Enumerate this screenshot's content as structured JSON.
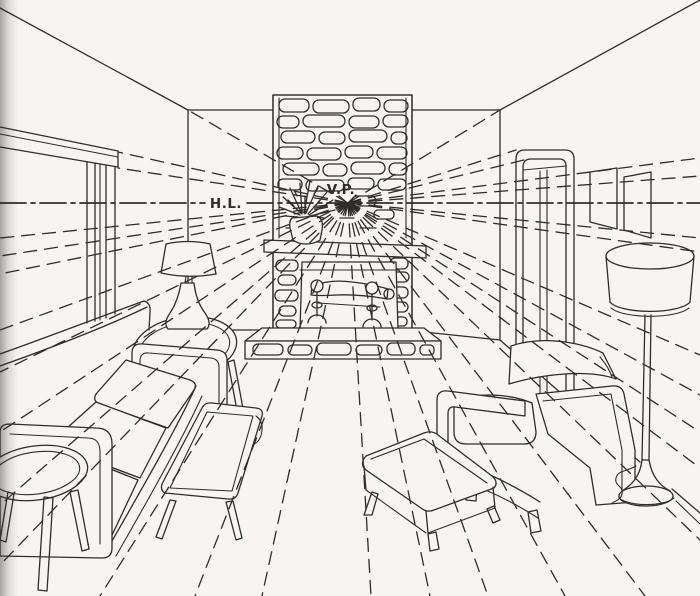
{
  "figure": {
    "labels": {
      "horizon_line": "H.L.",
      "vanishing_point": "V.P."
    },
    "colors": {
      "paper": "#f6f5f1",
      "ink": "#2f2d29"
    },
    "objects": [
      "window with cornice",
      "stone fireplace chimney",
      "mantel shelf with potted plant",
      "firebox with andirons and log",
      "stone hearth",
      "three-cushion sofa",
      "end table with table lamp",
      "round side stool",
      "wood bench",
      "armchair",
      "ottoman",
      "floor lamp with drum shade",
      "door",
      "two wall pictures"
    ]
  }
}
